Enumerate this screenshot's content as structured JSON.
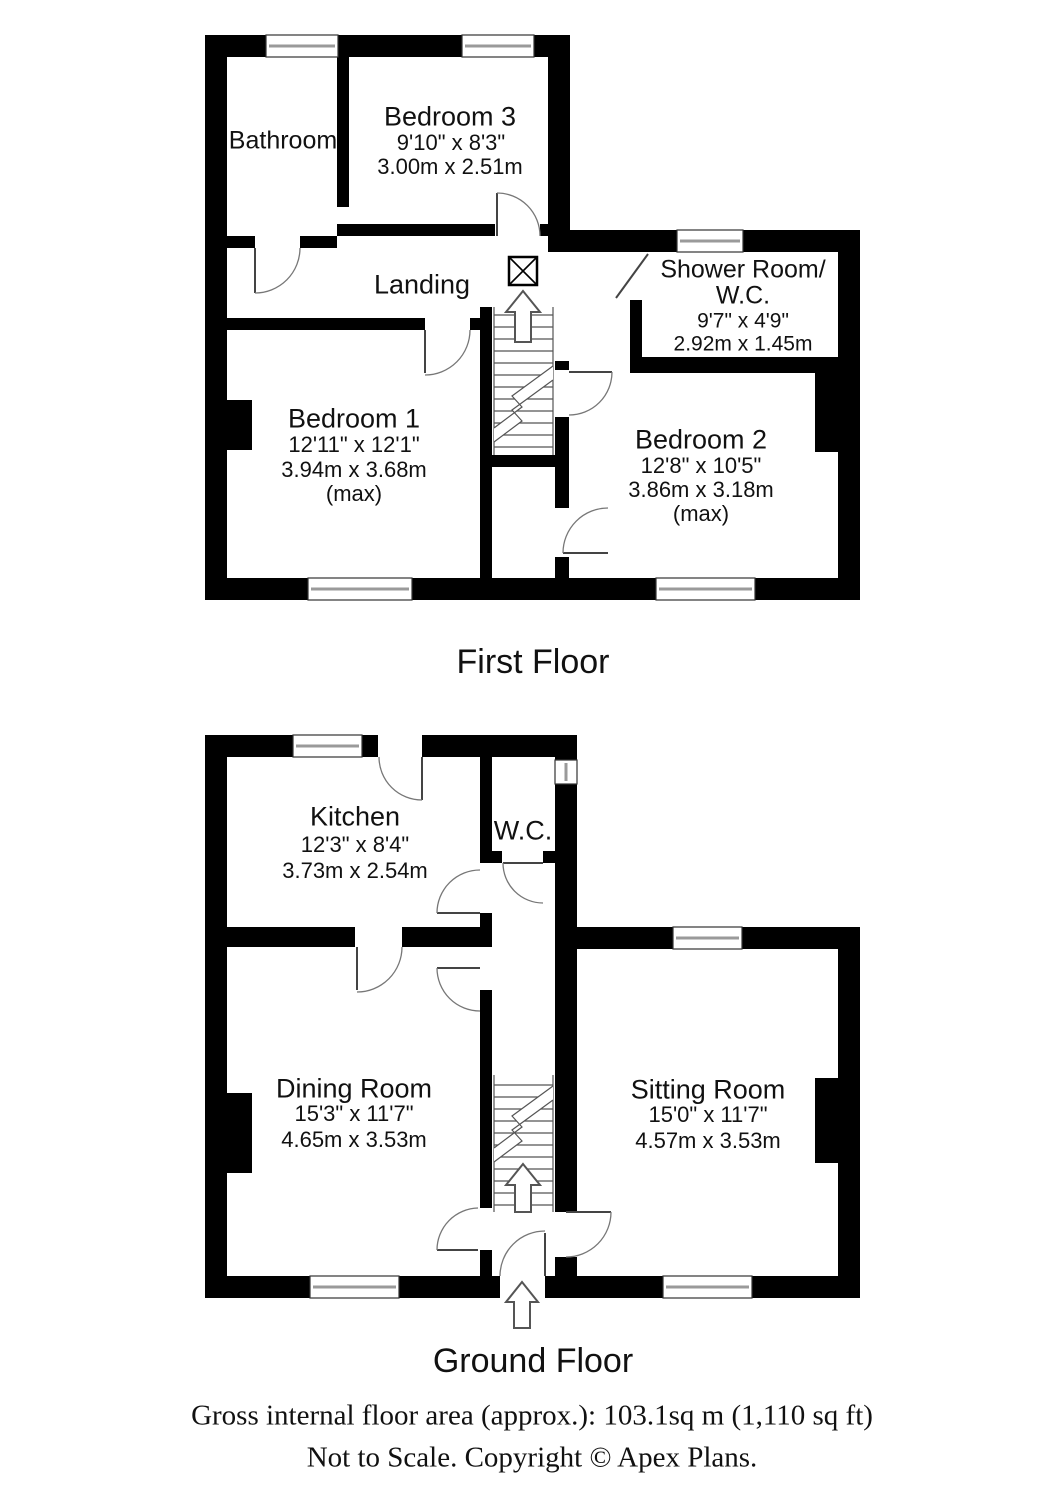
{
  "first_floor": {
    "title": "First Floor",
    "rooms": {
      "bathroom": {
        "name": "Bathroom"
      },
      "bedroom3": {
        "name": "Bedroom 3",
        "dims_ft": "9'10\" x 8'3\"",
        "dims_m": "3.00m x 2.51m"
      },
      "landing": {
        "name": "Landing"
      },
      "shower_wc": {
        "name_line1": "Shower Room/",
        "name_line2": "W.C.",
        "dims_ft": "9'7\" x 4'9\"",
        "dims_m": "2.92m x 1.45m"
      },
      "bedroom1": {
        "name": "Bedroom 1",
        "dims_ft": "12'11\" x 12'1\"",
        "dims_m": "3.94m x 3.68m",
        "note": "(max)"
      },
      "bedroom2": {
        "name": "Bedroom 2",
        "dims_ft": "12'8\" x 10'5\"",
        "dims_m": "3.86m x 3.18m",
        "note": "(max)"
      }
    }
  },
  "ground_floor": {
    "title": "Ground Floor",
    "rooms": {
      "kitchen": {
        "name": "Kitchen",
        "dims_ft": "12'3\" x 8'4\"",
        "dims_m": "3.73m x 2.54m"
      },
      "wc": {
        "name": "W.C."
      },
      "dining": {
        "name": "Dining Room",
        "dims_ft": "15'3\" x 11'7\"",
        "dims_m": "4.65m x 3.53m"
      },
      "sitting": {
        "name": "Sitting Room",
        "dims_ft": "15'0\" x 11'7\"",
        "dims_m": "4.57m x 3.53m"
      }
    }
  },
  "footer": {
    "area_line": "Gross internal floor area (approx.): 103.1sq m (1,110 sq ft)",
    "scale_line": "Not to Scale. Copyright © Apex Plans."
  },
  "colors": {
    "wall": "#000000",
    "door_arc": "#777777",
    "window_glass": "#9a9a9a",
    "background": "#ffffff"
  }
}
